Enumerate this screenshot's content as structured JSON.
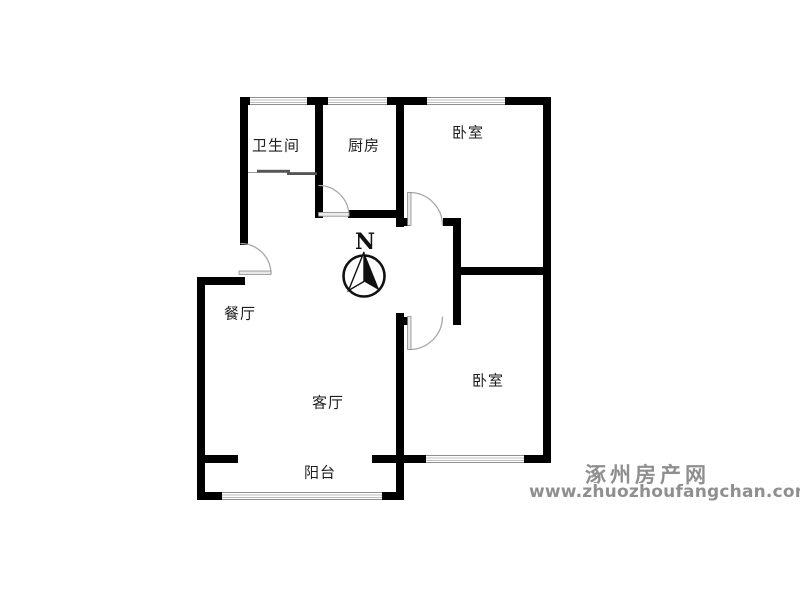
{
  "floor_plan": {
    "rooms": {
      "bathroom": {
        "label": "卫生间"
      },
      "kitchen": {
        "label": "厨房"
      },
      "bedroom_top": {
        "label": "卧室"
      },
      "dining": {
        "label": "餐厅"
      },
      "living": {
        "label": "客厅"
      },
      "bedroom_bottom": {
        "label": "卧室"
      },
      "balcony": {
        "label": "阳台"
      }
    },
    "compass": {
      "label": "N"
    },
    "colors": {
      "wall": "#000000",
      "door_arc": "#a8a8a8",
      "door_leaf": "#e8e8e8",
      "window_line": "#bdbdbd"
    }
  },
  "watermark": {
    "site_name": "涿州房产网",
    "site_url": "www.zhuozhoufangchan.com",
    "color": "#8f8f8f"
  }
}
